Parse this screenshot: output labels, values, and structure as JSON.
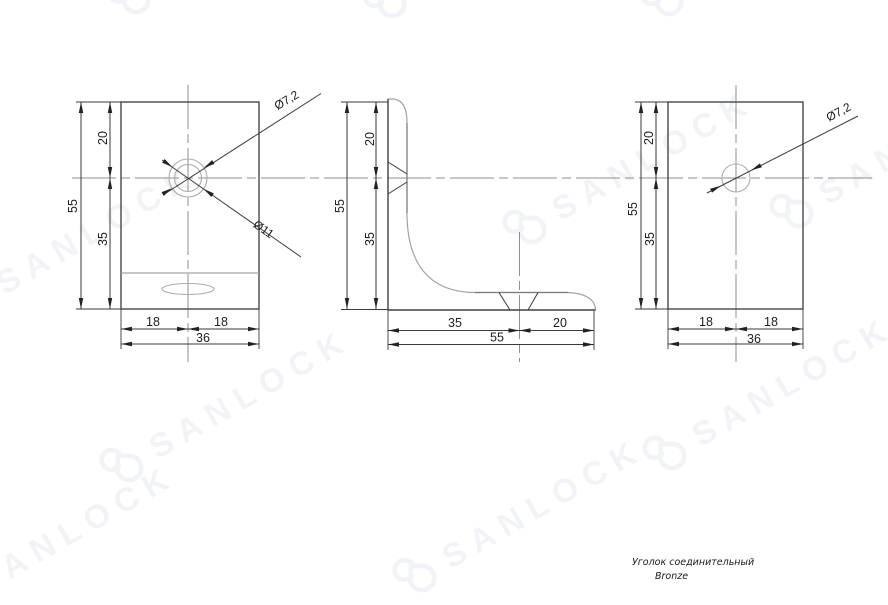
{
  "watermark": {
    "text": "SANLOCK",
    "icon": "open-padlock",
    "color": "#f1f3f7"
  },
  "title_block": {
    "line1": "Уголок соединительный",
    "line2": "Bronze"
  },
  "views": {
    "front": {
      "dims": {
        "height": "55",
        "top": "20",
        "bottom": "35",
        "left": "18",
        "right": "18",
        "width": "36"
      },
      "callouts": {
        "hole": "Ø7,2",
        "counterbore": "Ø11"
      }
    },
    "side": {
      "dims": {
        "height": "55",
        "top": "20",
        "bottom": "35",
        "leg": "35",
        "end": "20",
        "width": "55"
      }
    },
    "back": {
      "dims": {
        "height": "55",
        "top": "20",
        "bottom": "35",
        "left": "18",
        "right": "18",
        "width": "36"
      },
      "callouts": {
        "hole": "Ø7,2"
      }
    }
  },
  "colors": {
    "line": "#3a3a3a",
    "centerline": "#8f8f8f",
    "outline": "#474747",
    "watermark": "#f1f3f7"
  }
}
